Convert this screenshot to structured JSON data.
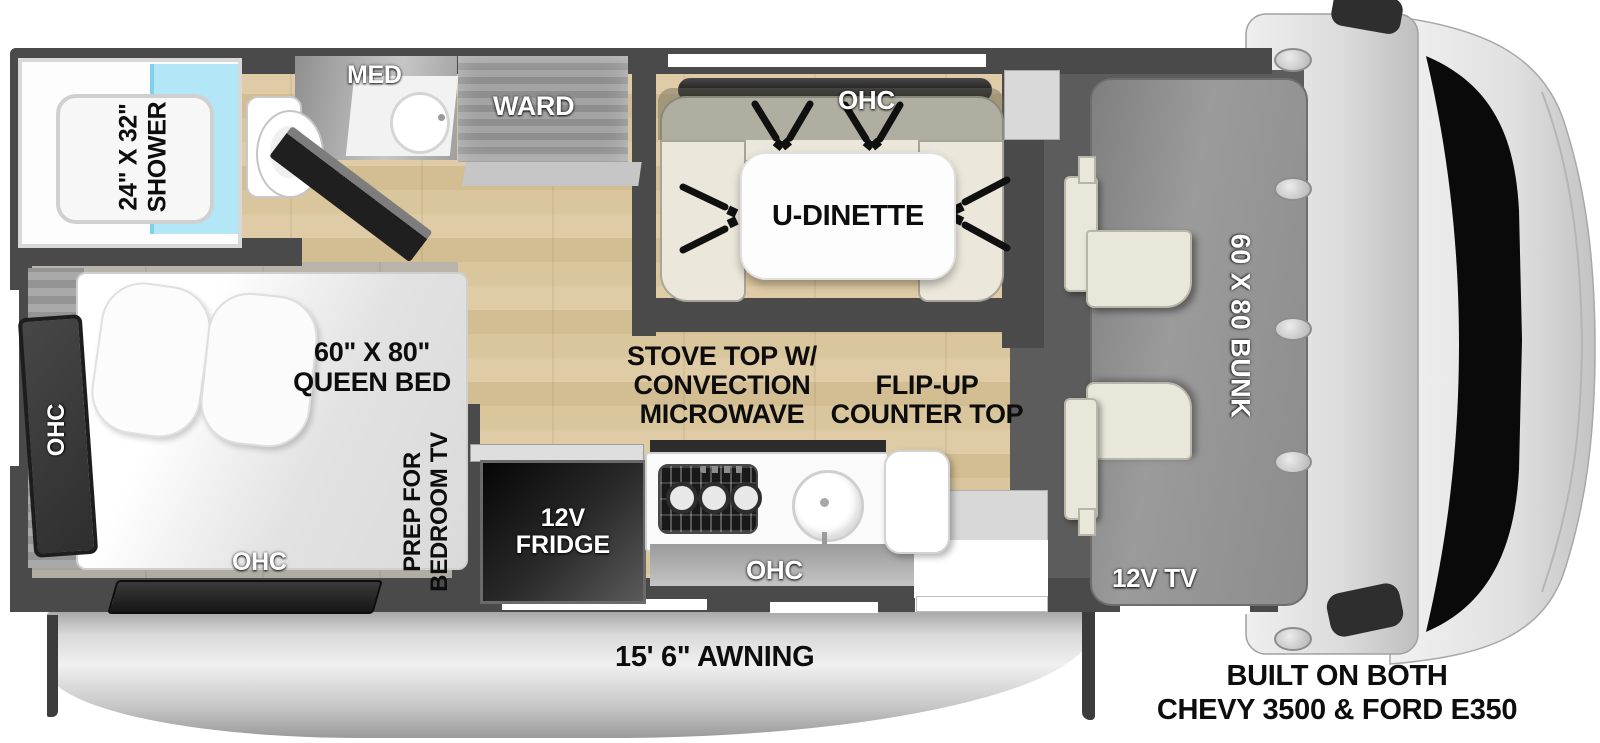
{
  "diagram_title": "Class C motorhome floorplan",
  "bathroom": {
    "shower_dim": "24\" X 32\"",
    "shower": "SHOWER",
    "med": "MED",
    "ward": "WARD"
  },
  "dinette": {
    "ohc": "OHC",
    "table": "U-DINETTE"
  },
  "kitchen": {
    "stove": [
      "STOVE TOP W/",
      "CONVECTION",
      "MICROWAVE"
    ],
    "flip_up": [
      "FLIP-UP",
      "COUNTER TOP"
    ],
    "fridge": [
      "12V",
      "FRIDGE"
    ],
    "ohc": "OHC"
  },
  "bedroom": {
    "bed": [
      "60\" X 80\"",
      "QUEEN BED"
    ],
    "tv_prep": [
      "PREP FOR",
      "BEDROOM TV"
    ],
    "ohc_rear": "OHC",
    "ohc_foot": "OHC"
  },
  "cab": {
    "bunk": "60 X 80 BUNK",
    "tv": "12V TV"
  },
  "exterior": {
    "awning": "15' 6\" AWNING",
    "chassis": [
      "BUILT ON BOTH",
      "CHEVY 3500 & FORD E350"
    ]
  },
  "colors": {
    "wall": "#4a4a4a",
    "wood_floor": "#d8c49c",
    "shower_glass": "#b3e7f7",
    "bench": "#ebe7da",
    "bunk": "#8f8f8f",
    "awning": "#c9c9c9"
  }
}
